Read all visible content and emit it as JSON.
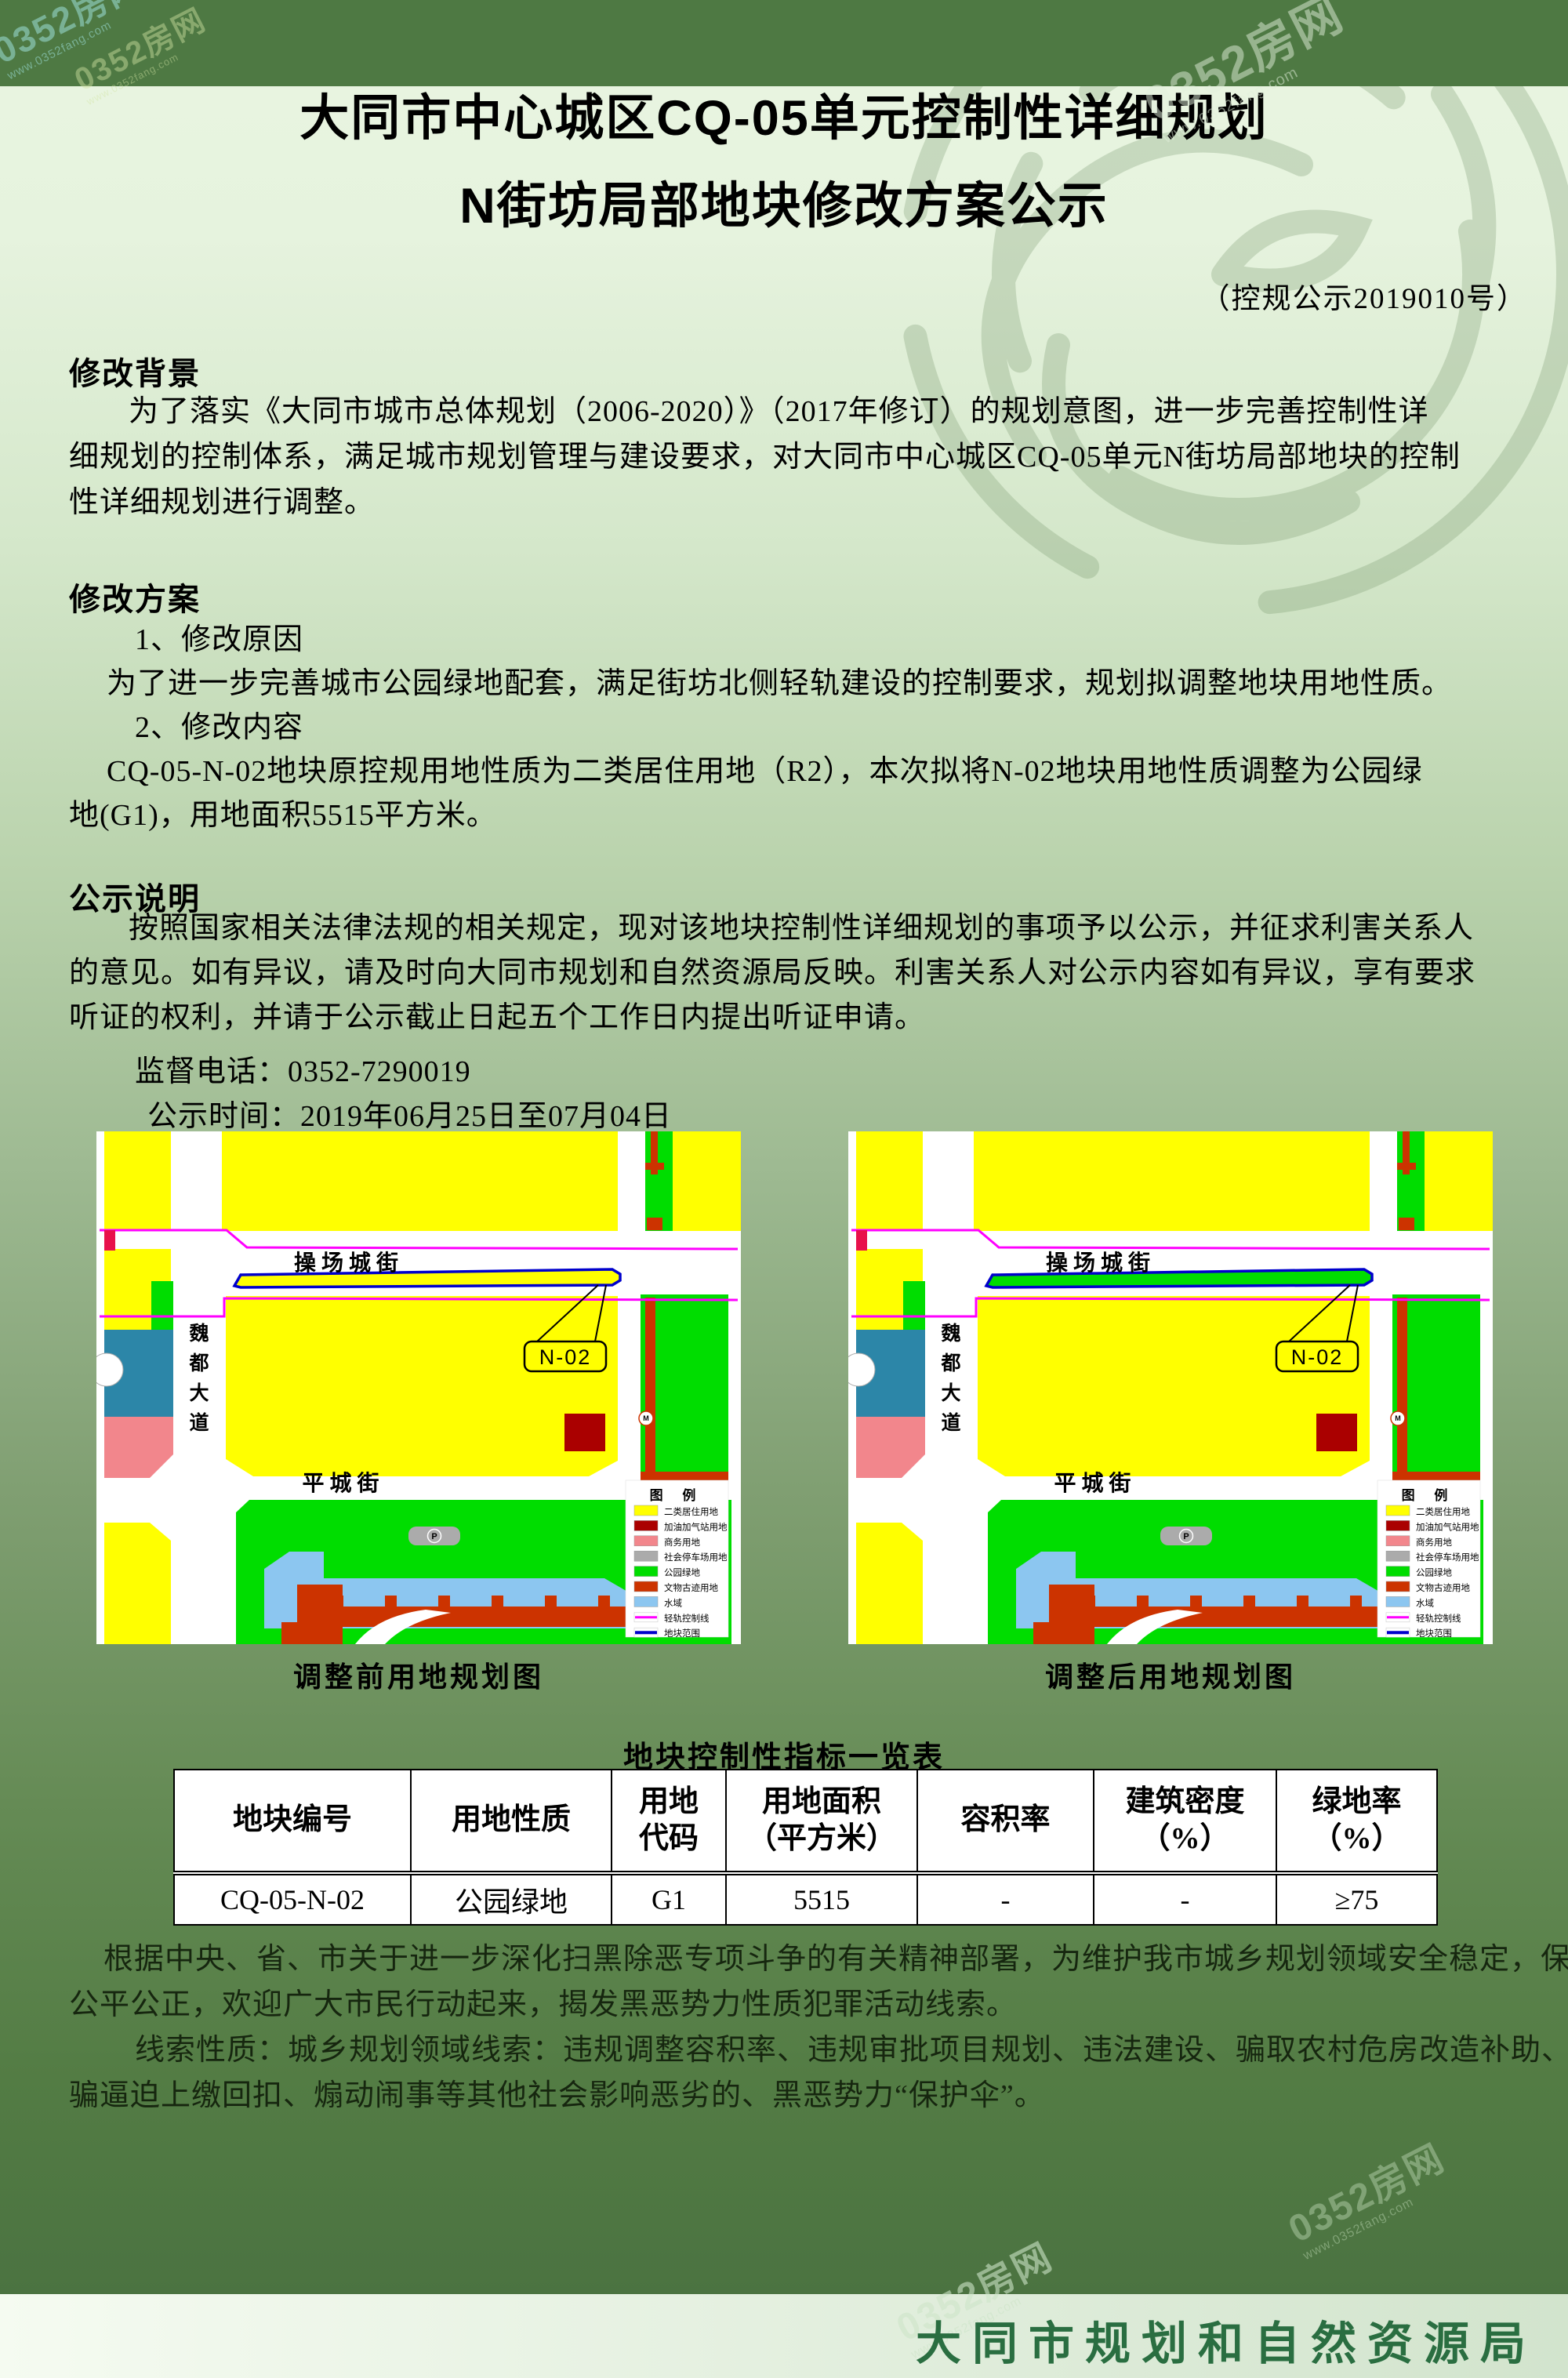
{
  "watermark": {
    "main": "0352房网",
    "sub": "www.0352fang.com"
  },
  "title": {
    "line1": "大同市中心城区CQ-05单元控制性详细规划",
    "line2": "N街坊局部地块修改方案公示",
    "doc_no": "（控规公示2019010号）"
  },
  "sections": {
    "background": {
      "heading": "修改背景",
      "lines": [
        "为了落实《大同市城市总体规划（2006-2020）》（2017年修订）的规划意图，进一步完善控制性详",
        "细规划的控制体系，满足城市规划管理与建设要求，对大同市中心城区CQ-05单元N街坊局部地块的控制",
        "性详细规划进行调整。"
      ]
    },
    "plan": {
      "heading": "修改方案",
      "items": [
        "1、修改原因",
        "为了进一步完善城市公园绿地配套，满足街坊北侧轻轨建设的控制要求，规划拟调整地块用地性质。",
        "2、修改内容",
        "CQ-05-N-02地块原控规用地性质为二类居住用地（R2），本次拟将N-02地块用地性质调整为公园绿",
        "地(G1)，用地面积5515平方米。"
      ]
    },
    "notice": {
      "heading": "公示说明",
      "lines": [
        "按照国家相关法律法规的相关规定，现对该地块控制性详细规划的事项予以公示，并征求利害关系人",
        "的意见。如有异议，请及时向大同市规划和自然资源局反映。利害关系人对公示内容如有异议，享有要求",
        "听证的权利，并请于公示截止日起五个工作日内提出听证申请。"
      ],
      "phone": "监督电话：0352-7290019",
      "period": "公示时间：2019年06月25日至07月04日"
    }
  },
  "maps": {
    "street_top": "操场城街",
    "street_bottom": "平城街",
    "street_left_chars": [
      "魏",
      "都",
      "大",
      "道"
    ],
    "n02": "N-02",
    "before": {
      "caption": "调整前用地规划图",
      "n02_fill": "#FFFF00"
    },
    "after": {
      "caption": "调整后用地规划图",
      "n02_fill": "#00DD00"
    },
    "colors": {
      "teal": "#2C86A8",
      "red_accent": "#E8114B"
    },
    "legend": {
      "title": "图 例",
      "items": [
        {
          "label": "二类居住用地",
          "color": "#FFFF00",
          "type": "swatch"
        },
        {
          "label": "加油加气站用地",
          "color": "#AA0000",
          "type": "swatch"
        },
        {
          "label": "商务用地",
          "color": "#F2868C",
          "type": "swatch"
        },
        {
          "label": "社会停车场用地",
          "color": "#ABABAB",
          "type": "swatch"
        },
        {
          "label": "公园绿地",
          "color": "#00DD00",
          "type": "swatch"
        },
        {
          "label": "文物古迹用地",
          "color": "#CC3300",
          "type": "swatch"
        },
        {
          "label": "水域",
          "color": "#8CC6F0",
          "type": "swatch"
        },
        {
          "label": "轻轨控制线",
          "color": "#FF00FF",
          "type": "line"
        },
        {
          "label": "地块范围",
          "color": "#0000CC",
          "type": "line"
        }
      ]
    }
  },
  "table": {
    "title": "地块控制性指标一览表",
    "headers": [
      [
        "地块编号"
      ],
      [
        "用地性质"
      ],
      [
        "用地",
        "代码"
      ],
      [
        "用地面积",
        "（平方米）"
      ],
      [
        "容积率"
      ],
      [
        "建筑密度",
        "（%）"
      ],
      [
        "绿地率",
        "（%）"
      ]
    ],
    "row": [
      "CQ-05-N-02",
      "公园绿地",
      "G1",
      "5515",
      "-",
      "-",
      "≥75"
    ]
  },
  "notes": {
    "lines": [
      "根据中央、省、市关于进一步深化扫黑除恶专项斗争的有关精神部署，为维护我市城乡规划领域安全稳定，保障",
      "公平公正，欢迎广大市民行动起来，揭发黑恶势力性质犯罪活动线索。",
      "线索性质：城乡规划领域线索：违规调整容积率、违规审批项目规划、违法建设、骗取农村危房改造补助、诱",
      "骗逼迫上缴回扣、煽动闹事等其他社会影响恶劣的、黑恶势力“保护伞”。"
    ]
  },
  "agency": "大同市规划和自然资源局"
}
